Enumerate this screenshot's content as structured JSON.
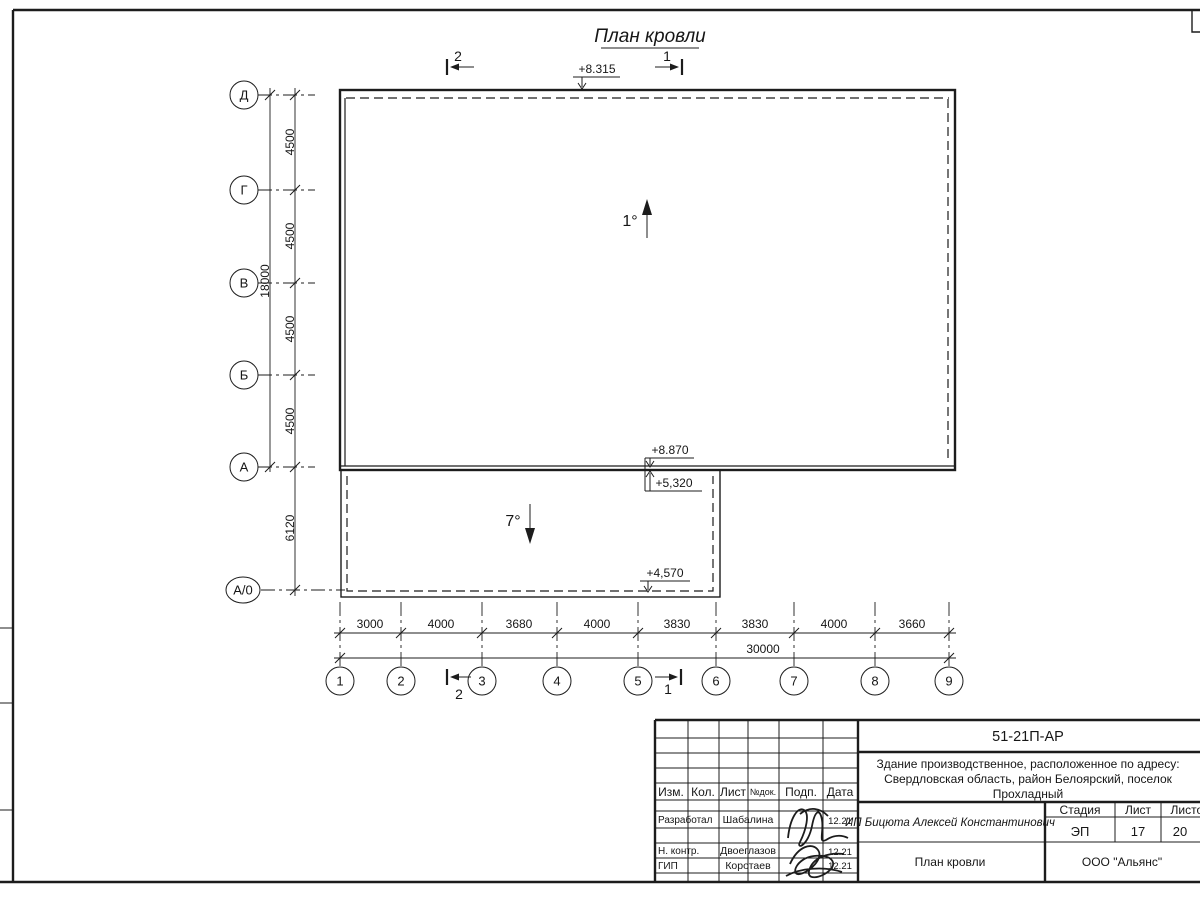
{
  "sheet": {
    "title": "План кровли"
  },
  "section_marks": {
    "top_left": "2",
    "top_right": "1",
    "bottom_left": "2",
    "bottom_right": "1"
  },
  "slopes": {
    "main": "1°",
    "annex": "7°"
  },
  "elevations": {
    "roof_top": "+8.315",
    "main_eave": "+8.870",
    "annex_top": "+5,320",
    "annex_eave": "+4,570"
  },
  "axes_left": {
    "labels": [
      "Д",
      "Г",
      "В",
      "Б",
      "А",
      "А/0"
    ]
  },
  "axes_bottom": {
    "labels": [
      "1",
      "2",
      "3",
      "4",
      "5",
      "6",
      "7",
      "8",
      "9"
    ]
  },
  "dims_left": {
    "segments": [
      "4500",
      "4500",
      "4500",
      "4500",
      "6120"
    ],
    "overall": "18000"
  },
  "dims_bottom": {
    "segments": [
      "3000",
      "4000",
      "3680",
      "4000",
      "3830",
      "3830",
      "4000",
      "3660"
    ],
    "overall": "30000"
  },
  "title_block": {
    "doc_number": "51-21П-АР",
    "object_description": [
      "Здание производственное, расположенное по адресу:",
      "Свердловская область, район Белоярский, поселок",
      "Прохладный"
    ],
    "client": "ИП Бицюта Алексей Константинович",
    "sheet_title": "План кровли",
    "company": "ООО \"Альянс\"",
    "header_cols": [
      "Изм.",
      "Кол.",
      "Лист",
      "№док.",
      "Подп.",
      "Дата"
    ],
    "stage_cols": [
      "Стадия",
      "Лист",
      "Листов"
    ],
    "stage_values": {
      "stage": "ЭП",
      "sheet": "17",
      "sheets": "20"
    },
    "roles": [
      {
        "role": "Разработал",
        "name": "Шабалина",
        "date": "12.21"
      },
      {
        "role": "Н. контр.",
        "name": "Двоеглазов",
        "date": "12.21"
      },
      {
        "role": "ГИП",
        "name": "Коротаев",
        "date": "12.21"
      }
    ]
  }
}
